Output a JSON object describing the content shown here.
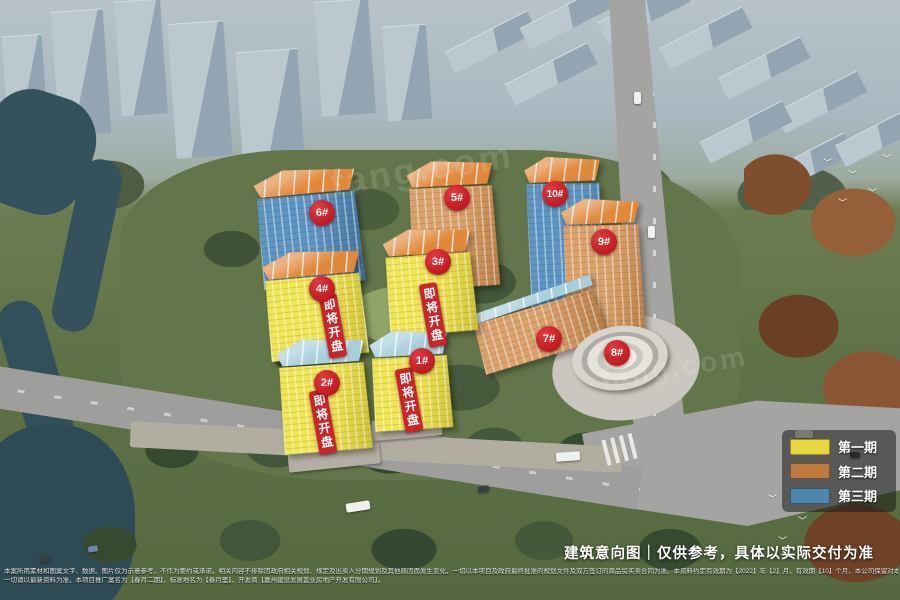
{
  "caption": "建筑意向图｜仅供参考，具体以实际交付为准",
  "presale_banner": "即将开盘",
  "watermark": "fang.com",
  "buildings": [
    {
      "label": "1#",
      "facade": "yellow",
      "roof": "blue",
      "phase": "第一期",
      "presale": true
    },
    {
      "label": "2#",
      "facade": "yellow",
      "roof": "blue",
      "phase": "第一期",
      "presale": true
    },
    {
      "label": "3#",
      "facade": "yellow",
      "roof": "orange",
      "phase": "第一期",
      "presale": true
    },
    {
      "label": "4#",
      "facade": "yellow",
      "roof": "orange",
      "phase": "第一期",
      "presale": true
    },
    {
      "label": "5#",
      "facade": "orange",
      "roof": "orange",
      "phase": "第二期",
      "presale": false
    },
    {
      "label": "6#",
      "facade": "blue",
      "roof": "orange",
      "phase": "第三期",
      "presale": false
    },
    {
      "label": "7#",
      "facade": "orange",
      "roof": "blue",
      "phase": "第二期",
      "presale": false
    },
    {
      "label": "8#",
      "facade": "white",
      "roof": "white",
      "phase": "",
      "presale": false
    },
    {
      "label": "9#",
      "facade": "orange",
      "roof": "orange",
      "phase": "第二期",
      "presale": false
    },
    {
      "label": "10#",
      "facade": "blue",
      "roof": "orange",
      "phase": "第三期",
      "presale": false
    }
  ],
  "legend": {
    "items": [
      {
        "label": "第一期",
        "color": "#e8d73e"
      },
      {
        "label": "第二期",
        "color": "#bd7b3c"
      },
      {
        "label": "第三期",
        "color": "#4f86ad"
      }
    ]
  },
  "colors": {
    "badge_red": "#c82127",
    "banner_red": "#ce2429",
    "phase1_yellow": "#f1e654",
    "phase2_orange": "#dba26c",
    "phase3_blue": "#5e95c2"
  },
  "disclaimer": {
    "line1": "本案所用素材和图案文字、数据、图片仅为示意参考，不作为要约或承诺，相关内容不排除因政府相关规划、规定及出卖人分期规划及其他原因而发生变化，一切以本项目及政府最终批准的规划文件及双方签订的商品房买卖合同为准。本资料约定有效期为【2022】年【2】月，有效期【10】个月，本公司保留对本资料修改的权利且不再另行通知。",
    "line2": "一切请以最新资料为准，本项目推广案名为【春月二期】，标准地名为【春月里】，开发商【嘉州建设发展置业房地产开发有限公司】。"
  }
}
